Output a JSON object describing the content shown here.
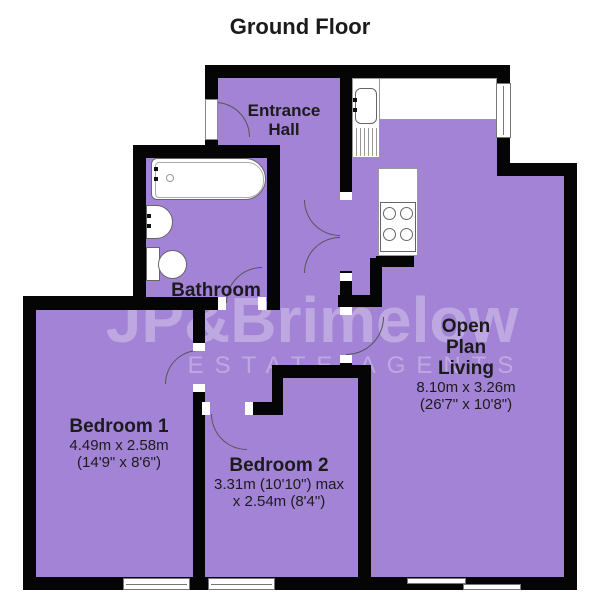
{
  "title": "Ground Floor",
  "watermark": {
    "line1": "JP&Brimelow",
    "line2": "ESTATE AGENTS"
  },
  "rooms": {
    "entrance_hall": {
      "name_line1": "Entrance",
      "name_line2": "Hall"
    },
    "bathroom": {
      "name": "Bathroom"
    },
    "bedroom1": {
      "name": "Bedroom 1",
      "dims_metric": "4.49m x 2.58m",
      "dims_imperial": "(14'9\" x 8'6\")"
    },
    "bedroom2": {
      "name": "Bedroom 2",
      "dims_line1": "3.31m (10'10\") max",
      "dims_line2": "x 2.54m (8'4\")"
    },
    "open_plan_living": {
      "name_line1": "Open",
      "name_line2": "Plan",
      "name_line3": "Living",
      "dims_metric": "8.10m x 3.26m",
      "dims_imperial": "(26'7\" x 10'8\")"
    }
  },
  "colors": {
    "room_fill": "#a383d5",
    "wall": "#050505",
    "fixture_white": "#ffffff",
    "label_text": "#1b1b1b"
  }
}
